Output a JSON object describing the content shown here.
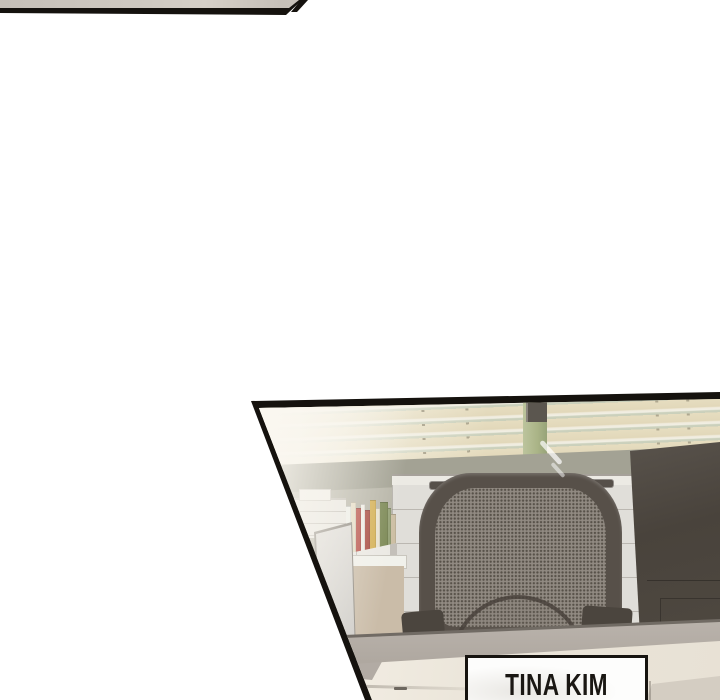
{
  "scene": {
    "type": "webtoon-office-panel",
    "background_color": "#ffffff",
    "panel_top": {
      "description": "thin sliver of previous comic panel",
      "fill_color": "#cac4bc",
      "border_color": "#15120e"
    },
    "panel_main": {
      "description": "office cubicle: window blinds, empty mesh office chair, monitor back, file cabinets, binders",
      "border_color": "#15120e"
    },
    "name_plate": {
      "text": "TINA KIM",
      "bg_color": "#fdfdfc",
      "border_color": "#16130f",
      "text_color": "#1a1713"
    },
    "colors": {
      "blind_slat": "#e6ddc0",
      "blind_gap": "#f1efe4",
      "blind_groove": "#cdd2be",
      "window_frame_green": "#aab487",
      "wall_sage": "#a3a294",
      "wall_base": "#b7b5a8",
      "cabinet_white": "#e0ded9",
      "drawer_handle": "#56504a",
      "chair_frame": "#575049",
      "chair_mesh": "#bcb5ac",
      "armrest": "#4b453e",
      "monitor_back": "#4d4741",
      "partition_gray": "#b5aea7",
      "desk_cream": "#ece6da",
      "tan_cabinet": "#cabca8"
    },
    "blinds": {
      "cords": [
        172,
        216,
        406,
        437
      ]
    },
    "books": {
      "stripes": [
        {
          "color": "#eef0e9",
          "w": 5,
          "h": 52
        },
        {
          "color": "#e5ddc6",
          "w": 5,
          "h": 56
        },
        {
          "color": "#b8524a",
          "w": 5,
          "h": 50
        },
        {
          "color": "#f0ede6",
          "w": 4,
          "h": 54
        },
        {
          "color": "#a84a40",
          "w": 5,
          "h": 48
        },
        {
          "color": "#d4b054",
          "w": 6,
          "h": 58
        },
        {
          "color": "#e8e2cf",
          "w": 4,
          "h": 50
        },
        {
          "color": "#7d8a57",
          "w": 8,
          "h": 56
        },
        {
          "color": "#96a277",
          "w": 3,
          "h": 50
        },
        {
          "color": "#cdbfa4",
          "w": 5,
          "h": 44
        }
      ]
    },
    "cabinet": {
      "handles": [
        {
          "x": 429,
          "y": 481
        },
        {
          "x": 494,
          "y": 483
        },
        {
          "x": 588,
          "y": 479
        },
        {
          "x": 494,
          "y": 519
        },
        {
          "x": 588,
          "y": 516
        },
        {
          "x": 494,
          "y": 585
        },
        {
          "x": 450,
          "y": 587
        },
        {
          "x": 588,
          "y": 582
        }
      ]
    }
  }
}
